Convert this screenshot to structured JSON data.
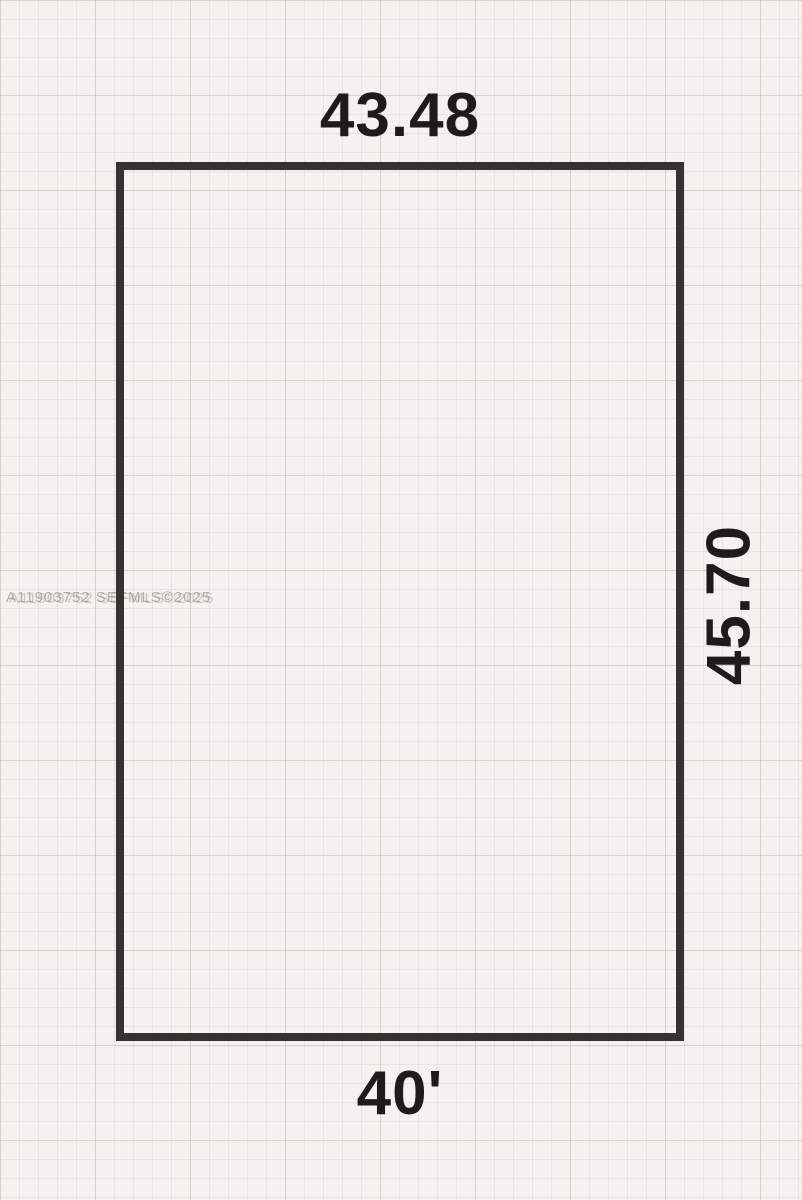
{
  "diagram": {
    "type": "property-lot-sketch",
    "dimensions": {
      "top": "43.48",
      "right": "45.70",
      "bottom": "40'"
    },
    "watermark": "A11903752 SEFMLS©2025",
    "colors": {
      "paper": "#f4f1ee",
      "grid_line": "#e4ded9",
      "lot_outline": "#35322f",
      "label_text": "#1d1c1a",
      "watermark_text": "#7d766f"
    }
  }
}
